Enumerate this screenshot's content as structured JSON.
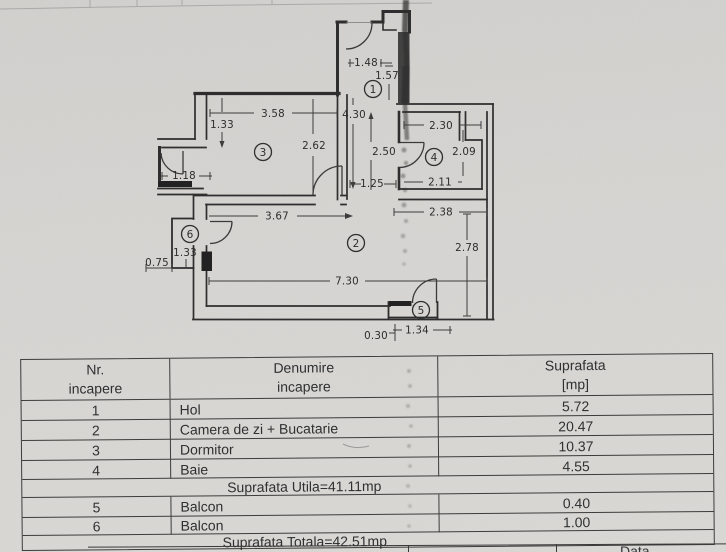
{
  "colors": {
    "paper": "#d6d4d1",
    "ink": "#2e2e2e"
  },
  "plan": {
    "rooms": {
      "r1": "1",
      "r2": "2",
      "r3": "3",
      "r4": "4",
      "r5": "5",
      "r6": "6"
    },
    "dims": {
      "d148": "1.48",
      "d157": "1.57",
      "d430": "4.30",
      "d250": "2.50",
      "d125": "1.25",
      "d358": "3.58",
      "d133a": "1.33",
      "d262": "2.62",
      "d230": "2.30",
      "d209": "2.09",
      "d211": "2.11",
      "d118": "1.18",
      "d238": "2.38",
      "d367": "3.67",
      "d278": "2.78",
      "d730": "7.30",
      "d133b": "1.33",
      "d075": "0.75",
      "d134": "1.34",
      "d030": "0.30"
    }
  },
  "table": {
    "headers": {
      "nr_line1": "Nr.",
      "nr_line2": "incapere",
      "den_line1": "Denumire",
      "den_line2": "incapere",
      "sup_line1": "Suprafata",
      "sup_line2": "[mp]"
    },
    "rows": [
      {
        "nr": "1",
        "name": "Hol",
        "area": "5.72"
      },
      {
        "nr": "2",
        "name": "Camera de zi + Bucatarie",
        "area": "20.47"
      },
      {
        "nr": "3",
        "name": "Dormitor",
        "area": "10.37"
      },
      {
        "nr": "4",
        "name": "Baie",
        "area": "4.55"
      }
    ],
    "subtotal": "Suprafata Utila=41.11mp",
    "rows2": [
      {
        "nr": "5",
        "name": "Balcon",
        "area": "0.40"
      },
      {
        "nr": "6",
        "name": "Balcon",
        "area": "1.00"
      }
    ],
    "total": "Suprafata Totala=42.51mp"
  },
  "footer": {
    "data_label": "Data"
  }
}
